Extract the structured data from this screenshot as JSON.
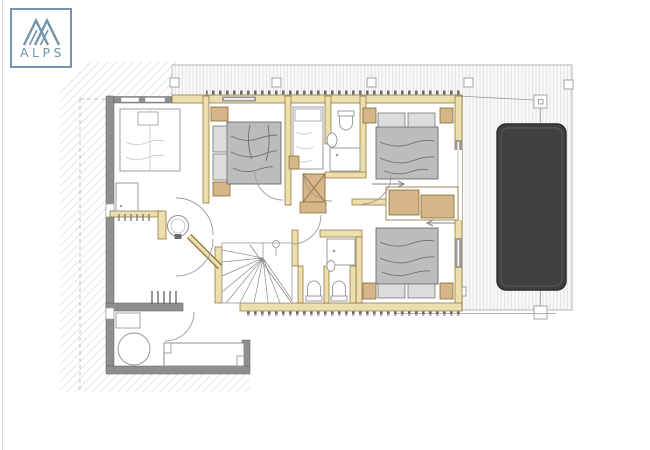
{
  "page": {
    "width": 650,
    "height": 450,
    "background": "#ffffff"
  },
  "logo": {
    "text": "ALPS",
    "color": "#7295ab",
    "border_color": "#7295ab",
    "icon": "mountain-peaks-icon"
  },
  "palette": {
    "wall_gray": "#8f8f8f",
    "wall_outline": "#5f5f5f",
    "timber_wall": "#ecdfae",
    "timber_outline": "#8a6a30",
    "furniture_wood": "#d4b688",
    "bed_mattress": "#bcbcbc",
    "bed_pillow": "#dcdcdc",
    "hot_tub": "#404043",
    "deck_plank_line": "#e0e0e0",
    "hatch_line": "#cdcdcd",
    "thin_line": "#9b9b9b"
  },
  "plan": {
    "kind": "architectural floor plan, upper storey",
    "elements": [
      {
        "name": "balcony-terrace",
        "desc": "plank-hatched deck along top and right"
      },
      {
        "name": "hot-tub",
        "desc": "dark rounded rectangle on right deck"
      },
      {
        "name": "bedroom-top-left",
        "furniture": [
          "single-bed",
          "shower-tray",
          "radiator"
        ]
      },
      {
        "name": "bedroom-top-middle",
        "furniture": [
          "double-bed",
          "nightstand",
          "nightstand"
        ]
      },
      {
        "name": "single-bed-nook",
        "furniture": [
          "single-bed"
        ]
      },
      {
        "name": "bathroom-center",
        "furniture": [
          "toilet",
          "washbasin",
          "shower"
        ]
      },
      {
        "name": "bedroom-top-right",
        "furniture": [
          "double-bed",
          "nightstand",
          "sliding-door"
        ]
      },
      {
        "name": "bedroom-bottom-right",
        "furniture": [
          "double-bed",
          "nightstand",
          "nightstand"
        ]
      },
      {
        "name": "shower-wc-block",
        "furniture": [
          "shower",
          "washbasin",
          "toilet",
          "toilet"
        ]
      },
      {
        "name": "hall-bathroom",
        "furniture": [
          "round-washbasin",
          "shower-tray"
        ]
      },
      {
        "name": "staircase",
        "desc": "winder stair with fan treads"
      },
      {
        "name": "lounge-bottom-left",
        "furniture": [
          "round-table",
          "daybed-bench",
          "shelf"
        ]
      },
      {
        "name": "chimney-shaft",
        "desc": "crossed box"
      }
    ]
  }
}
